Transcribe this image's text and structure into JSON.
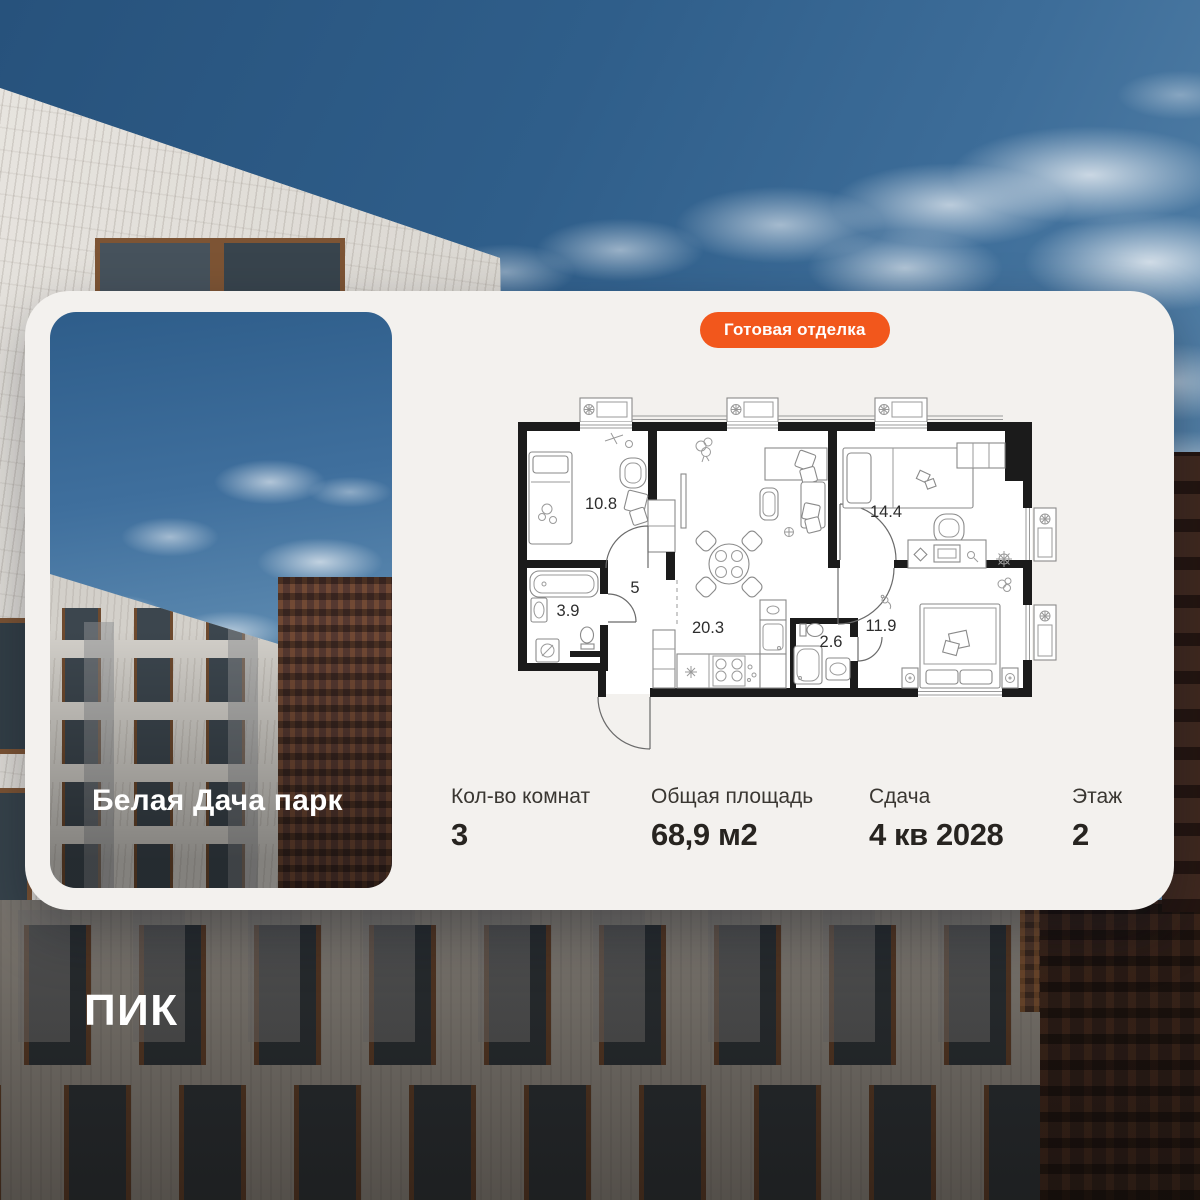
{
  "project": {
    "name": "Белая Дача парк"
  },
  "badge": {
    "label": "Готовая отделка"
  },
  "floorplan": {
    "rooms": [
      {
        "id": "bedroom-1",
        "area": "10.8"
      },
      {
        "id": "hallway",
        "area": "5"
      },
      {
        "id": "bathroom",
        "area": "3.9"
      },
      {
        "id": "kitchen-living",
        "area": "20.3"
      },
      {
        "id": "wc",
        "area": "2.6"
      },
      {
        "id": "bedroom-2",
        "area": "14.4"
      },
      {
        "id": "bedroom-3",
        "area": "11.9"
      }
    ]
  },
  "stats": [
    {
      "label": "Кол-во комнат",
      "value": "3"
    },
    {
      "label": "Общая площадь",
      "value": "68,9 м2"
    },
    {
      "label": "Сдача",
      "value": "4 кв 2028"
    },
    {
      "label": "Этаж",
      "value": "2"
    }
  ],
  "logo": {
    "text": "ПИК"
  },
  "colors": {
    "accent_orange": "#F2571C",
    "card_background": "#F3F1EE",
    "text_primary": "#272420",
    "text_secondary": "#3A3732",
    "sky_blue": "#2F5E8A"
  }
}
